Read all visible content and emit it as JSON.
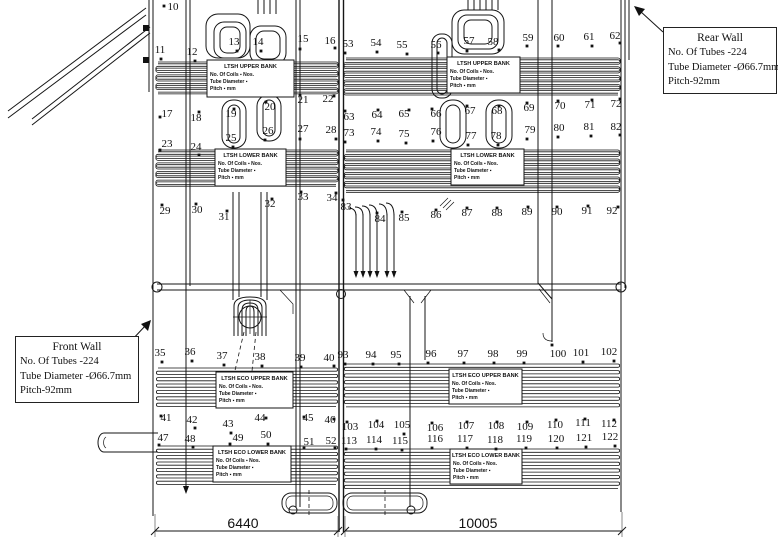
{
  "callouts": {
    "rear_wall": {
      "title": "Rear Wall",
      "lines": [
        "No. Of Tubes -224",
        "Tube Diameter -Ø66.7mm",
        "Pitch-92mm"
      ]
    },
    "front_wall": {
      "title": "Front  Wall",
      "lines": [
        "No. Of Tubes -224",
        "Tube Diameter -Ø66.7mm",
        "Pitch-92mm"
      ]
    }
  },
  "bank_label_lines": {
    "coils": "No. Of Coils ▪      Nos.",
    "diameter": "Tube Diameter ▪",
    "pitch": "Pitch ▪      mm"
  },
  "bank_labels": [
    {
      "title": "LTSH UPPER BANK",
      "x": 207,
      "y": 60,
      "w": 87,
      "h": 37
    },
    {
      "title": "LTSH UPPER BANK",
      "x": 447,
      "y": 57,
      "w": 73,
      "h": 36
    },
    {
      "title": "LTSH LOWER BANK",
      "x": 215,
      "y": 149,
      "w": 71,
      "h": 37
    },
    {
      "title": "LTSH LOWER BANK",
      "x": 451,
      "y": 149,
      "w": 73,
      "h": 36
    },
    {
      "title": "LTSH ECO UPPER BANK",
      "x": 216,
      "y": 372,
      "w": 77,
      "h": 36
    },
    {
      "title": "LTSH ECO UPPER BANK",
      "x": 449,
      "y": 369,
      "w": 73,
      "h": 35
    },
    {
      "title": "LTSH ECO LOWER BANK",
      "x": 213,
      "y": 446,
      "w": 78,
      "h": 36
    },
    {
      "title": "LTSH ECO LOWER BANK",
      "x": 450,
      "y": 449,
      "w": 72,
      "h": 35
    }
  ],
  "dimensions": [
    {
      "label": "6440",
      "x1": 155,
      "x2": 338,
      "y": 531,
      "tx": 243
    },
    {
      "label": "10005",
      "x1": 345,
      "x2": 622,
      "y": 531,
      "tx": 478
    }
  ],
  "markers": [
    [
      10,
      173,
      10,
      164,
      6
    ],
    [
      11,
      160,
      53,
      161,
      59
    ],
    [
      12,
      192,
      55,
      195,
      61
    ],
    [
      13,
      234,
      45,
      237,
      51
    ],
    [
      14,
      258,
      45,
      261,
      51
    ],
    [
      15,
      303,
      42,
      300,
      49
    ],
    [
      16,
      330,
      44,
      335,
      48
    ],
    [
      53,
      348,
      47,
      345,
      53
    ],
    [
      54,
      376,
      46,
      377,
      52
    ],
    [
      55,
      402,
      48,
      407,
      54
    ],
    [
      56,
      436,
      48,
      438,
      53
    ],
    [
      57,
      469,
      44,
      467,
      51
    ],
    [
      58,
      493,
      45,
      499,
      50
    ],
    [
      59,
      528,
      41,
      527,
      46
    ],
    [
      60,
      559,
      41,
      558,
      46
    ],
    [
      61,
      589,
      40,
      592,
      46
    ],
    [
      62,
      615,
      39,
      620,
      43
    ],
    [
      17,
      167,
      117,
      160,
      117
    ],
    [
      18,
      196,
      121,
      199,
      112
    ],
    [
      19,
      231,
      117,
      234,
      109
    ],
    [
      20,
      270,
      110,
      266,
      102
    ],
    [
      21,
      303,
      103,
      300,
      95
    ],
    [
      22,
      328,
      102,
      334,
      96
    ],
    [
      63,
      349,
      120,
      345,
      111
    ],
    [
      64,
      377,
      118,
      378,
      110
    ],
    [
      65,
      404,
      117,
      409,
      110
    ],
    [
      66,
      436,
      117,
      432,
      109
    ],
    [
      67,
      470,
      114,
      467,
      106
    ],
    [
      68,
      497,
      114,
      499,
      106
    ],
    [
      69,
      529,
      111,
      527,
      103
    ],
    [
      70,
      560,
      109,
      558,
      101
    ],
    [
      71,
      590,
      108,
      592,
      100
    ],
    [
      72,
      616,
      107,
      620,
      99
    ],
    [
      23,
      167,
      147,
      160,
      150
    ],
    [
      24,
      196,
      150,
      199,
      155
    ],
    [
      25,
      231,
      141,
      233,
      147
    ],
    [
      26,
      268,
      134,
      265,
      140
    ],
    [
      27,
      303,
      132,
      300,
      139
    ],
    [
      28,
      331,
      133,
      336,
      139
    ],
    [
      73,
      349,
      136,
      345,
      142
    ],
    [
      74,
      376,
      135,
      378,
      141
    ],
    [
      75,
      404,
      137,
      406,
      143
    ],
    [
      76,
      436,
      135,
      433,
      141
    ],
    [
      77,
      471,
      139,
      468,
      145
    ],
    [
      78,
      496,
      139,
      498,
      145
    ],
    [
      79,
      530,
      133,
      527,
      139
    ],
    [
      80,
      559,
      131,
      558,
      137
    ],
    [
      81,
      589,
      130,
      591,
      136
    ],
    [
      82,
      616,
      130,
      620,
      135
    ],
    [
      29,
      165,
      214,
      162,
      205
    ],
    [
      30,
      197,
      213,
      196,
      204
    ],
    [
      31,
      224,
      220,
      227,
      211
    ],
    [
      32,
      270,
      207,
      272,
      199
    ],
    [
      33,
      303,
      200,
      301,
      192
    ],
    [
      34,
      332,
      201,
      336,
      193
    ],
    [
      83,
      346,
      210,
      343,
      200
    ],
    [
      84,
      380,
      222,
      377,
      213
    ],
    [
      85,
      404,
      221,
      402,
      212
    ],
    [
      86,
      436,
      218,
      436,
      210
    ],
    [
      87,
      467,
      216,
      467,
      208
    ],
    [
      88,
      497,
      216,
      497,
      208
    ],
    [
      89,
      527,
      215,
      528,
      207
    ],
    [
      90,
      557,
      215,
      557,
      207
    ],
    [
      91,
      587,
      214,
      588,
      206
    ],
    [
      92,
      612,
      214,
      618,
      207
    ],
    [
      35,
      160,
      356,
      162,
      362
    ],
    [
      36,
      190,
      355,
      192,
      361
    ],
    [
      37,
      222,
      359,
      224,
      365
    ],
    [
      38,
      260,
      360,
      262,
      366
    ],
    [
      39,
      300,
      361,
      301,
      367
    ],
    [
      40,
      329,
      361,
      334,
      366
    ],
    [
      93,
      343,
      358,
      345,
      364
    ],
    [
      94,
      371,
      358,
      373,
      364
    ],
    [
      95,
      396,
      358,
      399,
      364
    ],
    [
      96,
      431,
      357,
      428,
      363
    ],
    [
      97,
      463,
      357,
      464,
      363
    ],
    [
      98,
      493,
      357,
      494,
      363
    ],
    [
      99,
      522,
      357,
      524,
      363
    ],
    [
      100,
      558,
      357,
      552,
      345
    ],
    [
      101,
      581,
      356,
      583,
      362
    ],
    [
      102,
      609,
      355,
      614,
      361
    ],
    [
      41,
      166,
      421,
      161,
      416
    ],
    [
      42,
      192,
      423,
      195,
      428
    ],
    [
      43,
      228,
      427,
      231,
      433
    ],
    [
      44,
      260,
      421,
      266,
      418
    ],
    [
      45,
      308,
      421,
      304,
      417
    ],
    [
      46,
      330,
      423,
      334,
      419
    ],
    [
      103,
      350,
      430,
      347,
      422
    ],
    [
      104,
      376,
      428,
      377,
      421
    ],
    [
      105,
      402,
      428,
      404,
      434
    ],
    [
      106,
      435,
      431,
      432,
      423
    ],
    [
      107,
      466,
      429,
      467,
      422
    ],
    [
      108,
      496,
      429,
      497,
      422
    ],
    [
      109,
      525,
      430,
      527,
      422
    ],
    [
      110,
      555,
      428,
      556,
      420
    ],
    [
      111,
      583,
      426,
      585,
      419
    ],
    [
      112,
      609,
      427,
      614,
      420
    ],
    [
      47,
      163,
      441,
      159,
      445
    ],
    [
      48,
      190,
      442,
      193,
      447
    ],
    [
      49,
      238,
      441,
      230,
      444
    ],
    [
      50,
      266,
      438,
      268,
      444
    ],
    [
      51,
      309,
      445,
      304,
      448
    ],
    [
      52,
      331,
      444,
      335,
      448
    ],
    [
      113,
      349,
      444,
      346,
      449
    ],
    [
      114,
      374,
      443,
      376,
      449
    ],
    [
      115,
      400,
      444,
      402,
      450
    ],
    [
      116,
      435,
      442,
      432,
      448
    ],
    [
      117,
      465,
      442,
      467,
      448
    ],
    [
      118,
      495,
      443,
      496,
      449
    ],
    [
      119,
      524,
      442,
      526,
      448
    ],
    [
      120,
      556,
      442,
      557,
      448
    ],
    [
      121,
      584,
      441,
      586,
      447
    ],
    [
      122,
      610,
      440,
      615,
      446
    ]
  ]
}
